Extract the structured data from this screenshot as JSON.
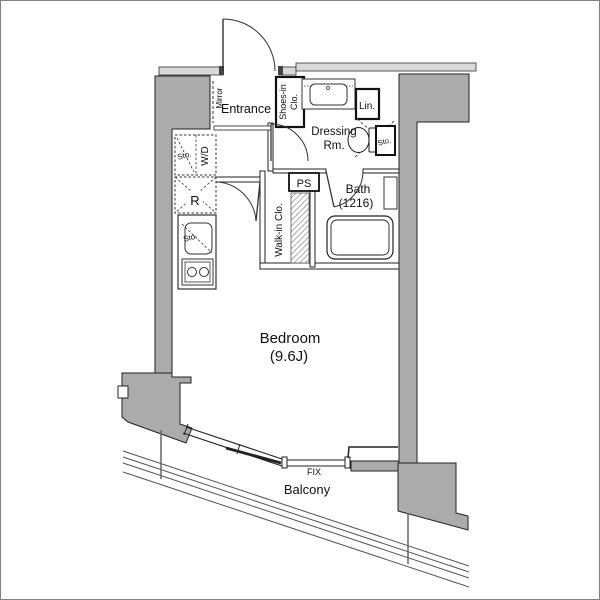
{
  "colors": {
    "pillar": "#ababab",
    "band": "#d9d9d9",
    "line": "#222222",
    "rail": "#555555"
  },
  "plan": {
    "entrance": {
      "label": "Entrance",
      "mirror": "Mirror",
      "shoes_line1": "Shoes-in",
      "shoes_line2": "Clo."
    },
    "dressing": {
      "line1": "Dressing",
      "line2": "Rm.",
      "linen": "Lin.",
      "storage": "Sto."
    },
    "bath": {
      "label": "Bath",
      "size": "(1216)"
    },
    "hall": {
      "ps": "PS",
      "walkin": "Walk-in Clo."
    },
    "kitchen": {
      "storage": "Sto.",
      "washer": "W/D",
      "fridge": "R",
      "sink_storage": "Sto."
    },
    "bedroom": {
      "label": "Bedroom",
      "size": "(9.6J)"
    },
    "balcony": {
      "label": "Balcony",
      "fix": "FIX"
    }
  }
}
